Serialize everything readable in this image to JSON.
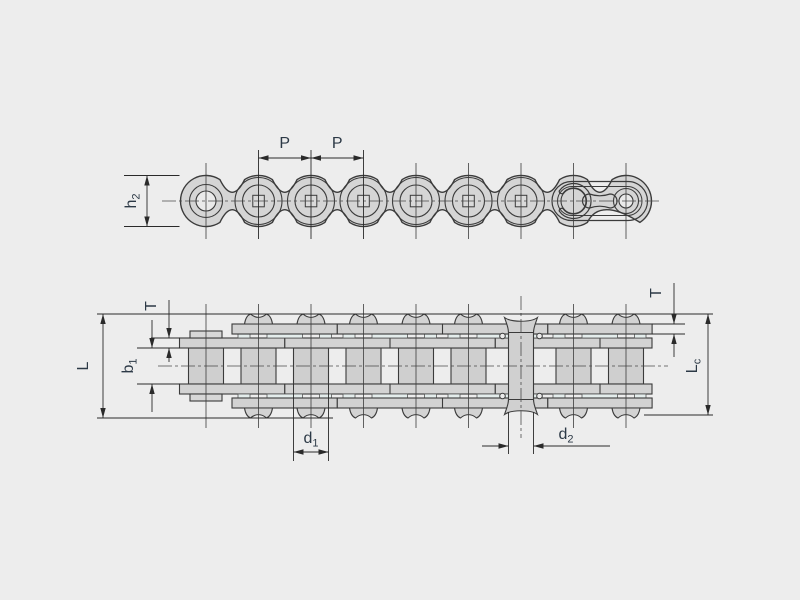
{
  "drawing": {
    "type": "technical-diagram",
    "subject": "roller chain - side elevation view and plan section view with dimension callouts",
    "colors": {
      "background": "#ededed",
      "part_fill": "#d5d5d5",
      "roller_fill": "#cfcfcf",
      "plate_fill": "#d3d3d3",
      "pin_fill": "#d0d0d0",
      "gap_strip": "#e4edec",
      "hole_fill": "#eaeaea",
      "outline": "#3b3b3b",
      "dimension_line": "#2a2a2a",
      "label_text": "#2c3946"
    }
  },
  "dim_labels": {
    "p1": {
      "text": "P",
      "sub": ""
    },
    "p2": {
      "text": "P",
      "sub": ""
    },
    "h2": {
      "text": "h",
      "sub": "2"
    },
    "L": {
      "text": "L",
      "sub": ""
    },
    "b1": {
      "text": "b",
      "sub": "1"
    },
    "t_left": {
      "text": "T",
      "sub": ""
    },
    "t_right": {
      "text": "T",
      "sub": ""
    },
    "Lc": {
      "text": "L",
      "sub": "c"
    },
    "d1": {
      "text": "d",
      "sub": "1"
    },
    "d2": {
      "text": "d",
      "sub": "2"
    }
  }
}
